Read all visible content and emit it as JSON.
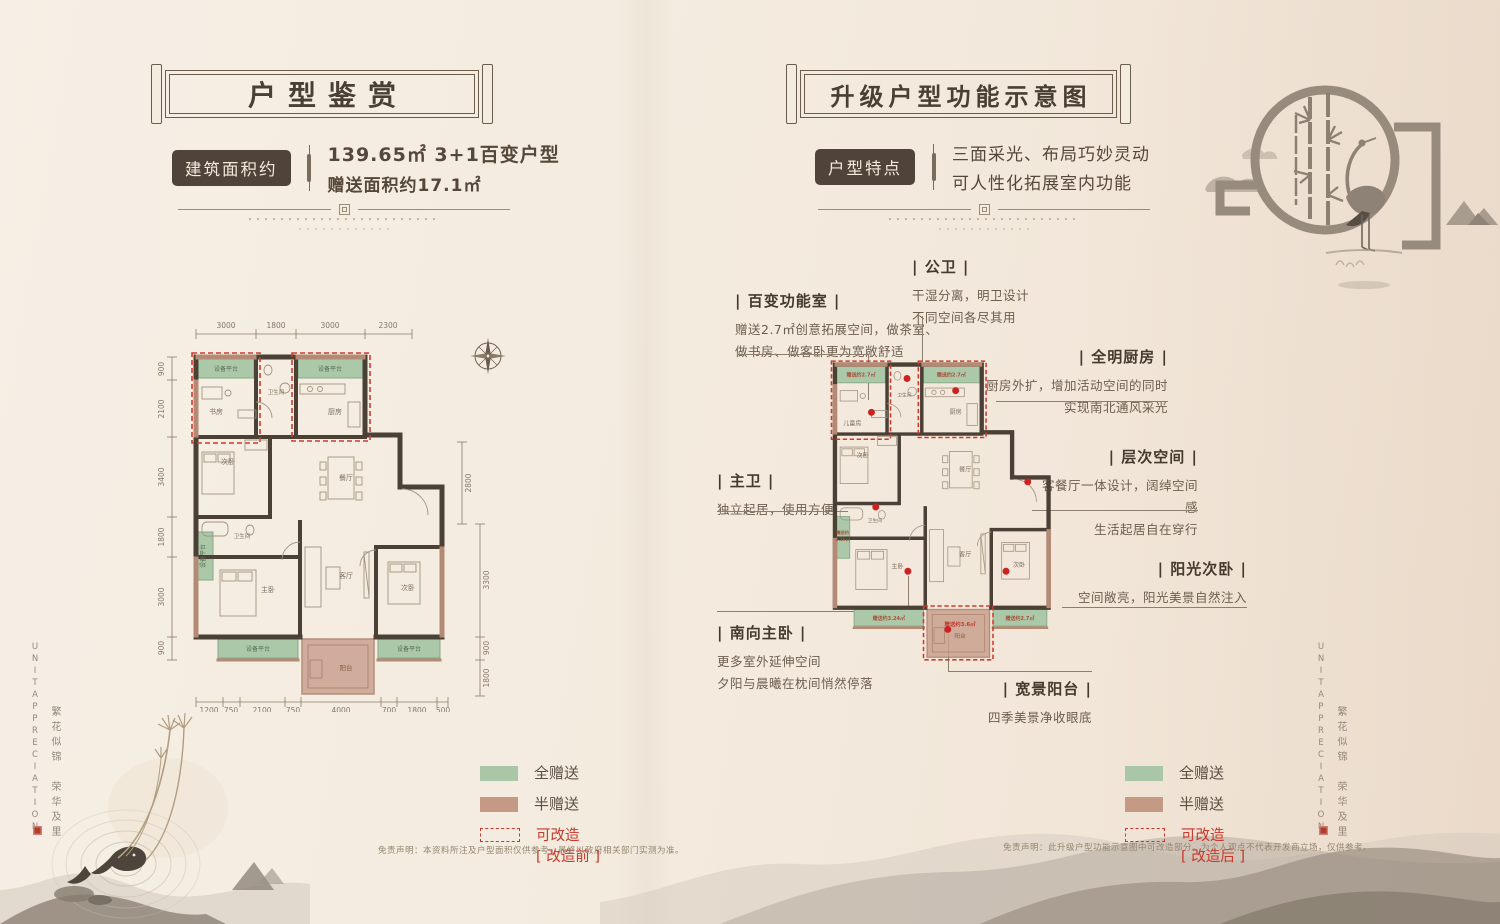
{
  "left_panel": {
    "banner_title": "户型鉴赏",
    "info": {
      "label": "建筑面积约",
      "line1": "139.65㎡ 3+1百变户型",
      "line2": "赠送面积约17.1㎡"
    },
    "legend": {
      "full": "全赠送",
      "half": "半赠送",
      "remodel": "可改造",
      "state": "[ 改造前 ]"
    },
    "disclaimer": "免责声明：本资料所注及户型面积仅供参考，最终以政府相关部门实测为准。",
    "floorplan": {
      "dims_top": [
        "3000",
        "1800",
        "3000",
        "2300"
      ],
      "dims_left": [
        "900",
        "2100",
        "3400",
        "1800",
        "3000",
        "900"
      ],
      "dims_right": [
        "2800",
        "3300",
        "900",
        "1800"
      ],
      "dims_bottom": [
        "1200",
        "750",
        "2100",
        "750",
        "4000",
        "700",
        "1800",
        "500"
      ],
      "rooms": {
        "platform": "设备平台",
        "study": "书房",
        "bath_top": "卫生间",
        "kitchen": "厨房",
        "bedroom_left": "次卧",
        "dining": "餐厅",
        "bath_mid": "卫生间",
        "master": "主卧",
        "living": "客厅",
        "bedroom_right": "次卧",
        "balcony": "阳台"
      }
    }
  },
  "right_panel": {
    "banner_title": "升级户型功能示意图",
    "info": {
      "label": "户型特点",
      "line1": "三面采光、布局巧妙灵动",
      "line2": "可人性化拓展室内功能"
    },
    "legend": {
      "full": "全赠送",
      "half": "半赠送",
      "remodel": "可改造",
      "state": "[ 改造后 ]"
    },
    "disclaimer": "免责声明：此升级户型功能示意图中可改造部分，为个人观点不代表开发商立场，仅供参考。",
    "annotations": {
      "flex_room": {
        "title": "| 百变功能室 |",
        "line1": "赠送2.7㎡创意拓展空间，做茶室、",
        "line2": "做书房、做客卧更为宽敞舒适"
      },
      "public_bath": {
        "title": "| 公卫 |",
        "line1": "干湿分离，明卫设计",
        "line2": "不同空间各尽其用"
      },
      "bright_kitchen": {
        "title": "| 全明厨房 |",
        "line1": "厨房外扩，增加活动空间的同时",
        "line2": "实现南北通风采光"
      },
      "master_bath": {
        "title": "| 主卫 |",
        "line1": "独立起居，使用方便"
      },
      "layered_space": {
        "title": "| 层次空间 |",
        "line1": "客餐厅一体设计，阔绰空间感",
        "line2": "生活起居自在穿行"
      },
      "sunny_bedroom": {
        "title": "| 阳光次卧 |",
        "line1": "空间敞亮，阳光美景自然注入"
      },
      "south_master": {
        "title": "| 南向主卧 |",
        "line1": "更多室外延伸空间",
        "line2": "夕阳与晨曦在枕间悄然停落"
      },
      "wide_balcony": {
        "title": "| 宽景阳台 |",
        "line1": "四季美景净收眼底"
      }
    },
    "floorplan": {
      "rooms": {
        "kids": "儿童房",
        "bath_top": "卫生间",
        "kitchen": "厨房",
        "bedroom_left": "次卧",
        "dining": "餐厅",
        "bath_mid": "卫生间",
        "master": "主卧",
        "living": "客厅",
        "bedroom_right": "次卧",
        "balcony": "阳台"
      },
      "gifts": {
        "g1": "赠送约2.7㎡",
        "g2": "赠送约2.7㎡",
        "g3a": "赠送约",
        "g3b": "2.16㎡",
        "g4": "赠送约3.24㎡",
        "g5": "赠送约2.7㎡",
        "g6": "赠送约3.6㎡"
      }
    }
  },
  "side_marks": {
    "en": "UNITAPPRECIATION",
    "cn": "繁花似锦　荣华及里"
  },
  "colors": {
    "full_gift": "#a9c7a6",
    "half_gift": "#c59a85",
    "remodel_red": "#c8382b",
    "ink": "#4c4134"
  }
}
